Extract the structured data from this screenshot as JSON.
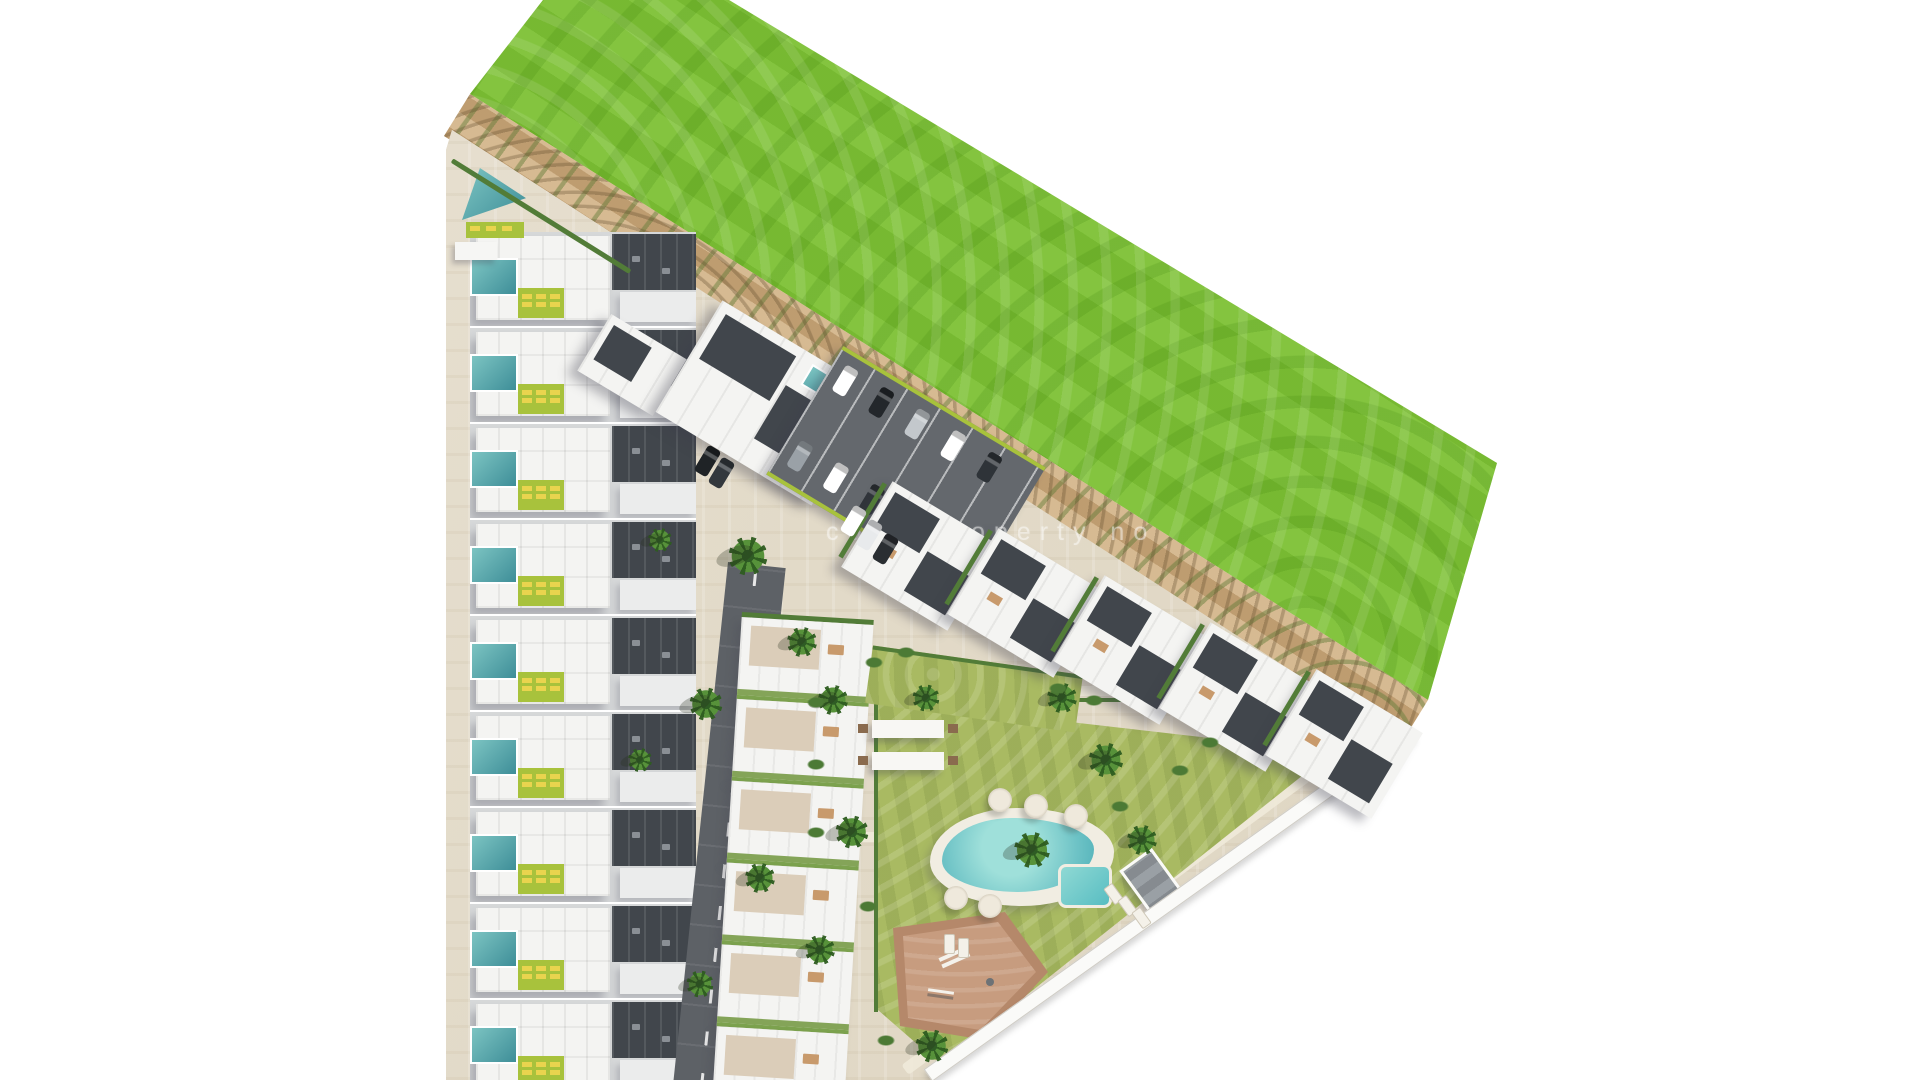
{
  "scene": {
    "description": "aerial-render-residential-site-plan",
    "watermark": {
      "text": "costaproperty no",
      "color": "#ffffff",
      "opacity": 0.5
    }
  },
  "palette": {
    "green_field": "#7cbe35",
    "dirt": "#c9a87c",
    "site": "#e5ddcd",
    "path": "#f0ead9",
    "wall": "#fafaf8",
    "road": "#5d6166",
    "asphalt": "#64686d",
    "roof_white": "#f4f4f2",
    "roof_dark": "#41464c",
    "pool_light": "#7cc4c2",
    "pool_deep": "#3e8e98",
    "pool_main": "#6ec3c6",
    "lawn": "#a9ba62",
    "lime": "#a8c23c",
    "lounger": "#e9d44e",
    "hedge": "#527c38",
    "play_dark": "#b5886a",
    "play_light": "#c79c7f"
  },
  "counts": {
    "townhouse_rows": 9,
    "mid_rows": 6,
    "apartment_blocks": 5
  },
  "apartment_block_row": {
    "start_x": 858,
    "start_y": 506,
    "step_x": 106,
    "step_y": 47
  },
  "parking": {
    "car_colors": [
      "#ffffff",
      "#23272b",
      "#c3c8cc",
      "#ffffff",
      "#2e3338",
      "#9aa1a7",
      "#ffffff",
      "#30353a",
      "#d8dbdd"
    ],
    "extra_cars": [
      [
        846,
        506,
        31,
        "#ffffff"
      ],
      [
        862,
        520,
        31,
        "#e8eaec"
      ],
      [
        878,
        534,
        31,
        "#2a2e32"
      ],
      [
        700,
        446,
        31,
        "#1f2326"
      ],
      [
        714,
        458,
        31,
        "#33383d"
      ]
    ]
  },
  "garden": {
    "palms": [
      [
        833,
        700,
        1
      ],
      [
        852,
        832,
        1.1
      ],
      [
        926,
        698,
        0.9
      ],
      [
        1062,
        698,
        1
      ],
      [
        1106,
        760,
        1.15
      ],
      [
        1032,
        850,
        1.2
      ],
      [
        1142,
        840,
        1
      ],
      [
        932,
        1046,
        1.1
      ],
      [
        820,
        950,
        1
      ],
      [
        748,
        556,
        1.3
      ],
      [
        802,
        642,
        1
      ],
      [
        706,
        704,
        1.1
      ],
      [
        700,
        984,
        0.9
      ],
      [
        760,
        878,
        1
      ],
      [
        660,
        540,
        0.8
      ],
      [
        640,
        760,
        0.8
      ]
    ],
    "shrubs": [
      [
        874,
        662
      ],
      [
        906,
        652
      ],
      [
        1058,
        688
      ],
      [
        1094,
        700
      ],
      [
        816,
        702
      ],
      [
        816,
        764
      ],
      [
        816,
        832
      ],
      [
        868,
        906
      ],
      [
        1120,
        806
      ],
      [
        1180,
        770
      ],
      [
        1210,
        742
      ],
      [
        886,
        1040
      ]
    ],
    "umbrellas": [
      [
        1000,
        800
      ],
      [
        1036,
        806
      ],
      [
        1076,
        816
      ],
      [
        956,
        898
      ],
      [
        990,
        906
      ]
    ],
    "pool_loungers": [
      [
        1108,
        884,
        -36
      ],
      [
        1122,
        896,
        -36
      ],
      [
        1136,
        908,
        -36
      ],
      [
        944,
        934,
        0
      ],
      [
        958,
        938,
        0
      ]
    ],
    "pergolas": [
      [
        872,
        720
      ],
      [
        872,
        752
      ]
    ]
  }
}
